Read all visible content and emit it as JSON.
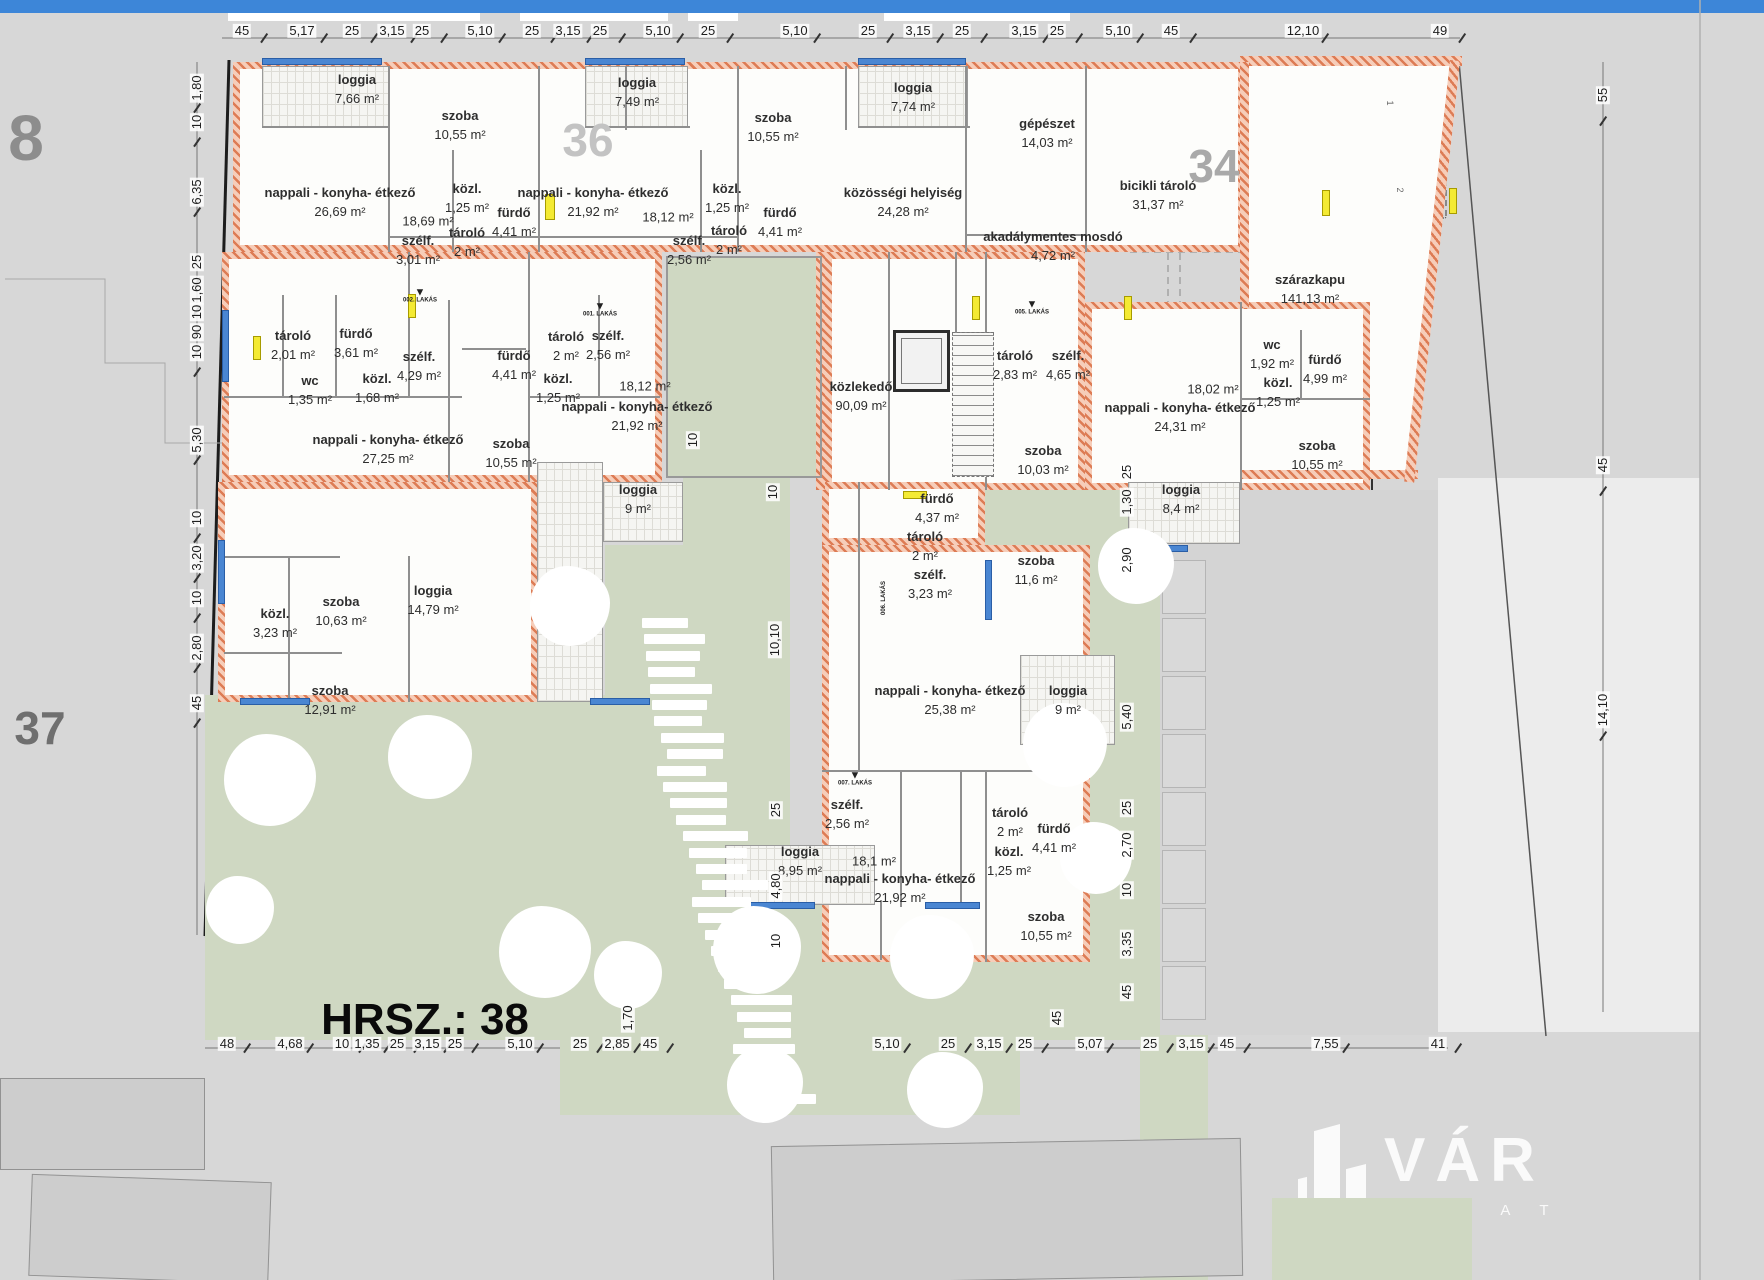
{
  "site": {
    "hrsz_label": "HRSZ.: 38",
    "big_labels": [
      {
        "text": "8",
        "x": 26,
        "y": 138,
        "size": 64,
        "color": "#8d8d8d"
      },
      {
        "text": "37",
        "x": 40,
        "y": 728,
        "size": 46,
        "color": "#6f6f6f"
      },
      {
        "text": "36",
        "x": 588,
        "y": 140,
        "size": 46,
        "color": "#c3c3c3"
      },
      {
        "text": "34",
        "x": 1214,
        "y": 166,
        "size": 46,
        "color": "#a9a9a9"
      },
      {
        "text": "HRSZ.: 38",
        "x": 345,
        "y": 1020,
        "size": 44,
        "color": "#0a0a0a"
      }
    ]
  },
  "logo": {
    "brand": "VÁR",
    "sub": "I N G A T L A"
  },
  "hall_numbers": [
    {
      "text": "1",
      "x": 1390,
      "y": 103
    },
    {
      "text": "2",
      "x": 1400,
      "y": 190
    }
  ],
  "unit_markers": [
    {
      "text": "002. LAKÁS",
      "x": 420,
      "y": 296
    },
    {
      "text": "001. LAKÁS",
      "x": 600,
      "y": 310
    },
    {
      "text": "005. LAKÁS",
      "x": 1032,
      "y": 308
    },
    {
      "text": "007. LAKÁS",
      "x": 855,
      "y": 779
    },
    {
      "text": "006. LAKÁS",
      "x": 884,
      "y": 598,
      "rot": 1
    }
  ],
  "rooms": [
    {
      "label": "loggia",
      "area": "7,66 m²",
      "x": 357,
      "y": 90
    },
    {
      "label": "szoba",
      "area": "10,55 m²",
      "x": 460,
      "y": 126
    },
    {
      "label": "nappali - konyha- étkező",
      "area": "26,69 m²",
      "x": 340,
      "y": 203
    },
    {
      "label": "",
      "area": "18,69 m²",
      "x": 428,
      "y": 222
    },
    {
      "label": "közl.",
      "area": "1,25 m²",
      "x": 467,
      "y": 199
    },
    {
      "label": "fürdő",
      "area": "4,41 m²",
      "x": 514,
      "y": 223
    },
    {
      "label": "tároló",
      "area": "2 m²",
      "x": 467,
      "y": 243
    },
    {
      "label": "szélf.",
      "area": "3,01 m²",
      "x": 418,
      "y": 251
    },
    {
      "label": "loggia",
      "area": "7,49 m²",
      "x": 637,
      "y": 93
    },
    {
      "label": "szoba",
      "area": "10,55 m²",
      "x": 773,
      "y": 128
    },
    {
      "label": "nappali - konyha- étkező",
      "area": "21,92 m²",
      "x": 593,
      "y": 203
    },
    {
      "label": "",
      "area": "18,12 m²",
      "x": 668,
      "y": 218
    },
    {
      "label": "közl.",
      "area": "1,25 m²",
      "x": 727,
      "y": 199
    },
    {
      "label": "tároló",
      "area": "2 m²",
      "x": 729,
      "y": 241
    },
    {
      "label": "szélf.",
      "area": "2,56 m²",
      "x": 689,
      "y": 251
    },
    {
      "label": "fürdő",
      "area": "4,41 m²",
      "x": 780,
      "y": 223
    },
    {
      "label": "loggia",
      "area": "7,74 m²",
      "x": 913,
      "y": 98
    },
    {
      "label": "közösségi helyiség",
      "area": "24,28 m²",
      "x": 903,
      "y": 203
    },
    {
      "label": "gépészet",
      "area": "14,03 m²",
      "x": 1047,
      "y": 134
    },
    {
      "label": "akadálymentes mosdó",
      "area": "4,72 m²",
      "x": 1053,
      "y": 247
    },
    {
      "label": "bicikli tároló",
      "area": "31,37 m²",
      "x": 1158,
      "y": 196
    },
    {
      "label": "szárazkapu",
      "area": "141,13 m²",
      "x": 1310,
      "y": 290
    },
    {
      "label": "tároló",
      "area": "2,01 m²",
      "x": 293,
      "y": 346
    },
    {
      "label": "fürdő",
      "area": "3,61 m²",
      "x": 356,
      "y": 344
    },
    {
      "label": "szélf.",
      "area": "4,29 m²",
      "x": 419,
      "y": 367
    },
    {
      "label": "wc",
      "area": "1,35 m²",
      "x": 310,
      "y": 391
    },
    {
      "label": "közl.",
      "area": "1,68 m²",
      "x": 377,
      "y": 389
    },
    {
      "label": "nappali - konyha- étkező",
      "area": "27,25 m²",
      "x": 388,
      "y": 450
    },
    {
      "label": "fürdő",
      "area": "4,41 m²",
      "x": 514,
      "y": 366
    },
    {
      "label": "tároló",
      "area": "2 m²",
      "x": 566,
      "y": 347
    },
    {
      "label": "szélf.",
      "area": "2,56 m²",
      "x": 608,
      "y": 346
    },
    {
      "label": "közl.",
      "area": "1,25 m²",
      "x": 558,
      "y": 389
    },
    {
      "label": "",
      "area": "18,12 m²",
      "x": 645,
      "y": 387
    },
    {
      "label": "nappali - konyha- étkező",
      "area": "21,92 m²",
      "x": 637,
      "y": 417
    },
    {
      "label": "szoba",
      "area": "10,55 m²",
      "x": 511,
      "y": 454
    },
    {
      "label": "loggia",
      "area": "9 m²",
      "x": 638,
      "y": 500
    },
    {
      "label": "közlekedő",
      "area": "90,09 m²",
      "x": 861,
      "y": 397
    },
    {
      "label": "tároló",
      "area": "2,83 m²",
      "x": 1015,
      "y": 366
    },
    {
      "label": "szélf.",
      "area": "4,65 m²",
      "x": 1068,
      "y": 366
    },
    {
      "label": "szoba",
      "area": "10,03 m²",
      "x": 1043,
      "y": 461
    },
    {
      "label": "fürdő",
      "area": "4,37 m²",
      "x": 937,
      "y": 509
    },
    {
      "label": "tároló",
      "area": "2 m²",
      "x": 925,
      "y": 547
    },
    {
      "label": "szélf.",
      "area": "3,23 m²",
      "x": 930,
      "y": 585
    },
    {
      "label": "szoba",
      "area": "11,6 m²",
      "x": 1036,
      "y": 571
    },
    {
      "label": "nappali - konyha- étkező",
      "area": "25,38 m²",
      "x": 950,
      "y": 701
    },
    {
      "label": "loggia",
      "area": "9 m²",
      "x": 1068,
      "y": 701
    },
    {
      "label": "nappali - konyha- étkező",
      "area": "24,31 m²",
      "x": 1180,
      "y": 418
    },
    {
      "label": "",
      "area": "18,02 m²",
      "x": 1213,
      "y": 390
    },
    {
      "label": "wc",
      "area": "1,92 m²",
      "x": 1272,
      "y": 355
    },
    {
      "label": "fürdő",
      "area": "4,99 m²",
      "x": 1325,
      "y": 370
    },
    {
      "label": "közl.",
      "area": "1,25 m²",
      "x": 1278,
      "y": 393
    },
    {
      "label": "szoba",
      "area": "10,55 m²",
      "x": 1317,
      "y": 456
    },
    {
      "label": "loggia",
      "area": "8,4 m²",
      "x": 1181,
      "y": 500
    },
    {
      "label": "közl.",
      "area": "3,23 m²",
      "x": 275,
      "y": 624
    },
    {
      "label": "szoba",
      "area": "10,63 m²",
      "x": 341,
      "y": 612
    },
    {
      "label": "loggia",
      "area": "14,79 m²",
      "x": 433,
      "y": 601
    },
    {
      "label": "szoba",
      "area": "12,91 m²",
      "x": 330,
      "y": 701
    },
    {
      "label": "szélf.",
      "area": "2,56 m²",
      "x": 847,
      "y": 815
    },
    {
      "label": "",
      "area": "18,1 m²",
      "x": 874,
      "y": 862
    },
    {
      "label": "nappali - konyha- étkező",
      "area": "21,92 m²",
      "x": 900,
      "y": 889
    },
    {
      "label": "tároló",
      "area": "2 m²",
      "x": 1010,
      "y": 823
    },
    {
      "label": "közl.",
      "area": "1,25 m²",
      "x": 1009,
      "y": 862
    },
    {
      "label": "fürdő",
      "area": "4,41 m²",
      "x": 1054,
      "y": 839
    },
    {
      "label": "szoba",
      "area": "10,55 m²",
      "x": 1046,
      "y": 927
    },
    {
      "label": "loggia",
      "area": "8,95 m²",
      "x": 800,
      "y": 862
    }
  ],
  "dims": {
    "top": [
      {
        "t": "45",
        "x": 242
      },
      {
        "t": "5,17",
        "x": 302
      },
      {
        "t": "25",
        "x": 352
      },
      {
        "t": "3,15",
        "x": 392
      },
      {
        "t": "25",
        "x": 422
      },
      {
        "t": "5,10",
        "x": 480
      },
      {
        "t": "25",
        "x": 532
      },
      {
        "t": "3,15",
        "x": 568
      },
      {
        "t": "25",
        "x": 600
      },
      {
        "t": "5,10",
        "x": 658
      },
      {
        "t": "25",
        "x": 708
      },
      {
        "t": "5,10",
        "x": 795
      },
      {
        "t": "25",
        "x": 868
      },
      {
        "t": "3,15",
        "x": 918
      },
      {
        "t": "25",
        "x": 962
      },
      {
        "t": "3,15",
        "x": 1024
      },
      {
        "t": "25",
        "x": 1057
      },
      {
        "t": "5,10",
        "x": 1118
      },
      {
        "t": "45",
        "x": 1171
      },
      {
        "t": "12,10",
        "x": 1303
      },
      {
        "t": "49",
        "x": 1440
      }
    ],
    "bottom": [
      {
        "t": "48",
        "x": 227
      },
      {
        "t": "4,68",
        "x": 290
      },
      {
        "t": "10",
        "x": 342
      },
      {
        "t": "1,35",
        "x": 367
      },
      {
        "t": "25",
        "x": 397
      },
      {
        "t": "3,15",
        "x": 427
      },
      {
        "t": "25",
        "x": 455
      },
      {
        "t": "5,10",
        "x": 520
      },
      {
        "t": "25",
        "x": 580
      },
      {
        "t": "2,85",
        "x": 617
      },
      {
        "t": "45",
        "x": 650
      },
      {
        "t": "5,10",
        "x": 887
      },
      {
        "t": "25",
        "x": 948
      },
      {
        "t": "3,15",
        "x": 989
      },
      {
        "t": "25",
        "x": 1025
      },
      {
        "t": "5,07",
        "x": 1090
      },
      {
        "t": "25",
        "x": 1150
      },
      {
        "t": "3,15",
        "x": 1191
      },
      {
        "t": "45",
        "x": 1227
      },
      {
        "t": "7,55",
        "x": 1326
      },
      {
        "t": "41",
        "x": 1438
      }
    ],
    "left": [
      {
        "t": "1,80",
        "y": 88
      },
      {
        "t": "10",
        "y": 122
      },
      {
        "t": "6,35",
        "y": 192
      },
      {
        "t": "25",
        "y": 262
      },
      {
        "t": "1,60",
        "y": 290
      },
      {
        "t": "10",
        "y": 312
      },
      {
        "t": "90",
        "y": 332
      },
      {
        "t": "10",
        "y": 352
      },
      {
        "t": "5,30",
        "y": 440
      },
      {
        "t": "10",
        "y": 518
      },
      {
        "t": "3,20",
        "y": 558
      },
      {
        "t": "10",
        "y": 598
      },
      {
        "t": "2,80",
        "y": 648
      },
      {
        "t": "45",
        "y": 703
      }
    ],
    "right": [
      {
        "t": "55",
        "y": 95
      },
      {
        "t": "45",
        "y": 465
      },
      {
        "t": "14,10",
        "y": 710
      }
    ],
    "inner": [
      {
        "t": "10",
        "x": 773,
        "y": 492
      },
      {
        "t": "10,10",
        "x": 775,
        "y": 640
      },
      {
        "t": "25",
        "x": 776,
        "y": 810
      },
      {
        "t": "4,80",
        "x": 776,
        "y": 886
      },
      {
        "t": "10",
        "x": 776,
        "y": 941
      },
      {
        "t": "1,70",
        "x": 628,
        "y": 1018
      },
      {
        "t": "10",
        "x": 693,
        "y": 440
      },
      {
        "t": "25",
        "x": 1127,
        "y": 472
      },
      {
        "t": "1,30",
        "x": 1127,
        "y": 502
      },
      {
        "t": "2,90",
        "x": 1127,
        "y": 560
      },
      {
        "t": "5,40",
        "x": 1127,
        "y": 717
      },
      {
        "t": "25",
        "x": 1127,
        "y": 808
      },
      {
        "t": "2,70",
        "x": 1127,
        "y": 845
      },
      {
        "t": "10",
        "x": 1127,
        "y": 890
      },
      {
        "t": "3,35",
        "x": 1127,
        "y": 944
      },
      {
        "t": "45",
        "x": 1127,
        "y": 992
      },
      {
        "t": "45",
        "x": 1057,
        "y": 1018
      }
    ]
  }
}
